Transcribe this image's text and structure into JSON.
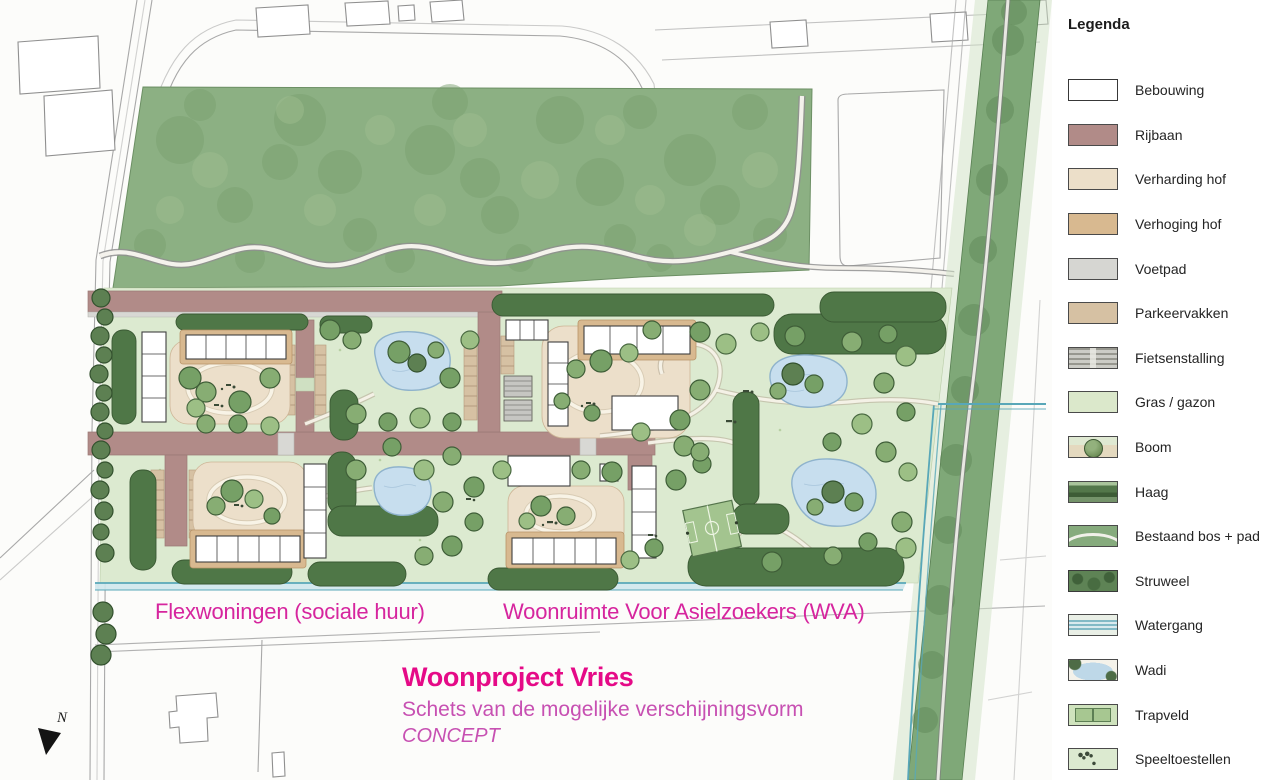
{
  "map": {
    "labels": {
      "area_left": "Flexwoningen (sociale huur)",
      "area_right": "Woonruimte Voor Asielzoekers (WVA)"
    },
    "title_block": {
      "title": "Woonproject Vries",
      "subtitle": "Schets van de mogelijke verschijningsvorm",
      "status": "CONCEPT"
    },
    "compass": {
      "label": "N"
    },
    "colors": {
      "label_magenta": "#d6259e",
      "title_magenta": "#e50a87",
      "subtitle_magenta": "#c750b2",
      "grass": "#dcead0",
      "forest": "#8cb083",
      "road": "#b18b88",
      "courtyard": "#ecdfca",
      "hedge": "#4f7747",
      "water": "#58a7b8",
      "wadi": "#c7deee"
    }
  },
  "legend": {
    "title": "Legenda",
    "items": [
      {
        "label": "Bebouwing",
        "color": "#ffffff",
        "swatch": "bebouwing"
      },
      {
        "label": "Rijbaan",
        "color": "#b18b88",
        "swatch": "rijbaan"
      },
      {
        "label": "Verharding hof",
        "color": "#ecdfc9",
        "swatch": "verharding-hof"
      },
      {
        "label": "Verhoging hof",
        "color": "#d8b990",
        "swatch": "verhoging-hof"
      },
      {
        "label": "Voetpad",
        "color": "#d6d6d2",
        "swatch": "voetpad"
      },
      {
        "label": "Parkeervakken",
        "color": "#d6c1a3",
        "swatch": "parkeervakken"
      },
      {
        "label": "Fietsenstalling",
        "color": "#b3b3ad",
        "swatch": "fietsenstalling"
      },
      {
        "label": "Gras / gazon",
        "color": "#dbe8cb",
        "swatch": "gras-gazon"
      },
      {
        "label": "Boom",
        "color": "#6e9260",
        "swatch": "boom"
      },
      {
        "label": "Haag",
        "color": "#4f7446",
        "swatch": "haag"
      },
      {
        "label": "Bestaand bos + pad",
        "color": "#86ab7d",
        "swatch": "bestaand-bos-pad"
      },
      {
        "label": "Struweel",
        "color": "#5e8355",
        "swatch": "struweel"
      },
      {
        "label": "Watergang",
        "color": "#82b9c6",
        "swatch": "watergang"
      },
      {
        "label": "Wadi",
        "color": "#bed8e8",
        "swatch": "wadi"
      },
      {
        "label": "Trapveld",
        "color": "#a7c791",
        "swatch": "trapveld"
      },
      {
        "label": "Speeltoestellen",
        "color": "#dcead0",
        "swatch": "speeltoestellen"
      }
    ]
  }
}
